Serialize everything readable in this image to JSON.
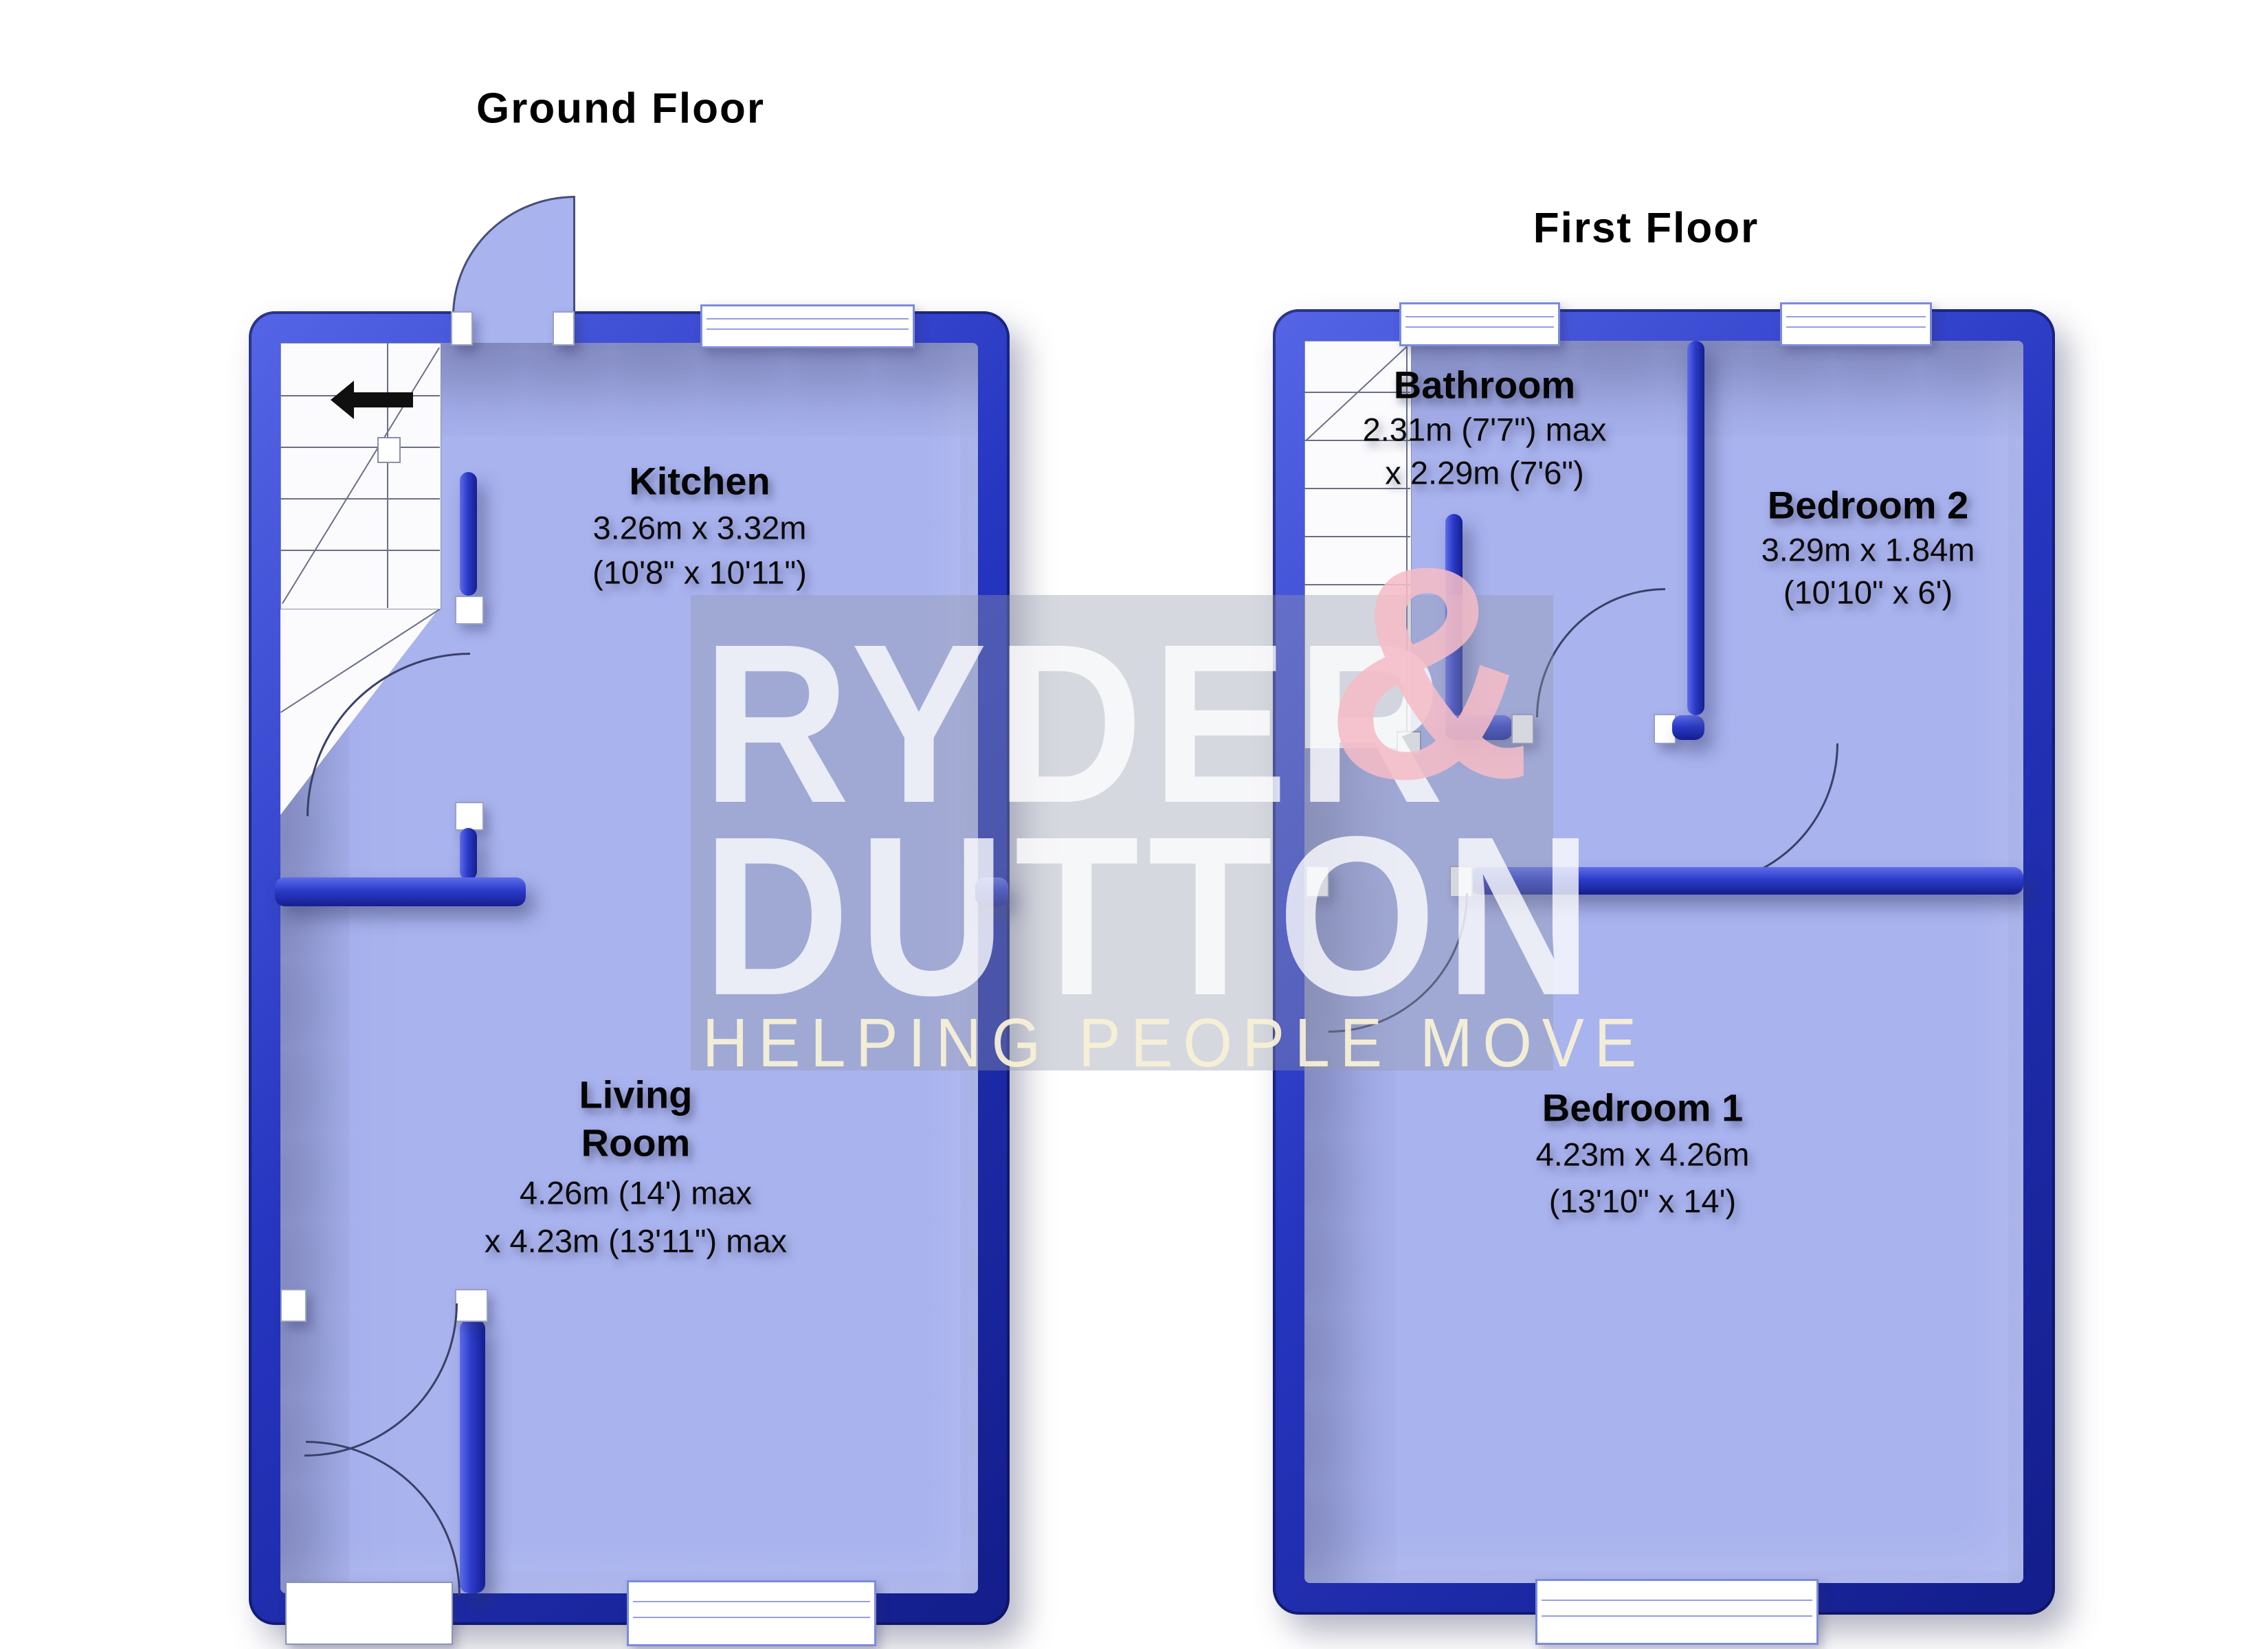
{
  "page": {
    "type": "estate-agent-floorplan",
    "background": "#FFFFFF"
  },
  "colors": {
    "wall_blue": "#2636C0",
    "wall_highlight": "#5D6CEA",
    "wall_dark": "#141E8F",
    "floor_fill": "#A9B3EE",
    "arc_line": "#3A4066",
    "watermark_box": "#9498AA",
    "watermark_text": "#FFFFFF",
    "watermark_ampersand": "#F4BCC7",
    "watermark_tagline": "#F7F0D6",
    "label_text": "#000000"
  },
  "floors": [
    {
      "title": "Ground Floor",
      "rooms": [
        {
          "name": "Kitchen",
          "dim_metric": "3.26m x 3.32m",
          "dim_imperial": "(10'8\" x 10'11\")"
        },
        {
          "name": "Living Room",
          "name_line1": "Living",
          "name_line2": "Room",
          "dim_metric": "4.26m (14') max",
          "dim_imperial": "x 4.23m (13'11\") max"
        }
      ]
    },
    {
      "title": "First Floor",
      "rooms": [
        {
          "name": "Bathroom",
          "dim_metric": "2.31m (7'7\") max",
          "dim_imperial": "x 2.29m (7'6\")"
        },
        {
          "name": "Bedroom 2",
          "dim_metric": "3.29m x 1.84m",
          "dim_imperial": "(10'10\" x 6')"
        },
        {
          "name": "Bedroom 1",
          "dim_metric": "4.23m x 4.26m",
          "dim_imperial": "(13'10\" x 14')"
        }
      ]
    }
  ],
  "watermark": {
    "brand_line1": "RYDER",
    "brand_amp": "&",
    "brand_line2": "DUTTON",
    "tagline": "HELPING PEOPLE MOVE"
  }
}
